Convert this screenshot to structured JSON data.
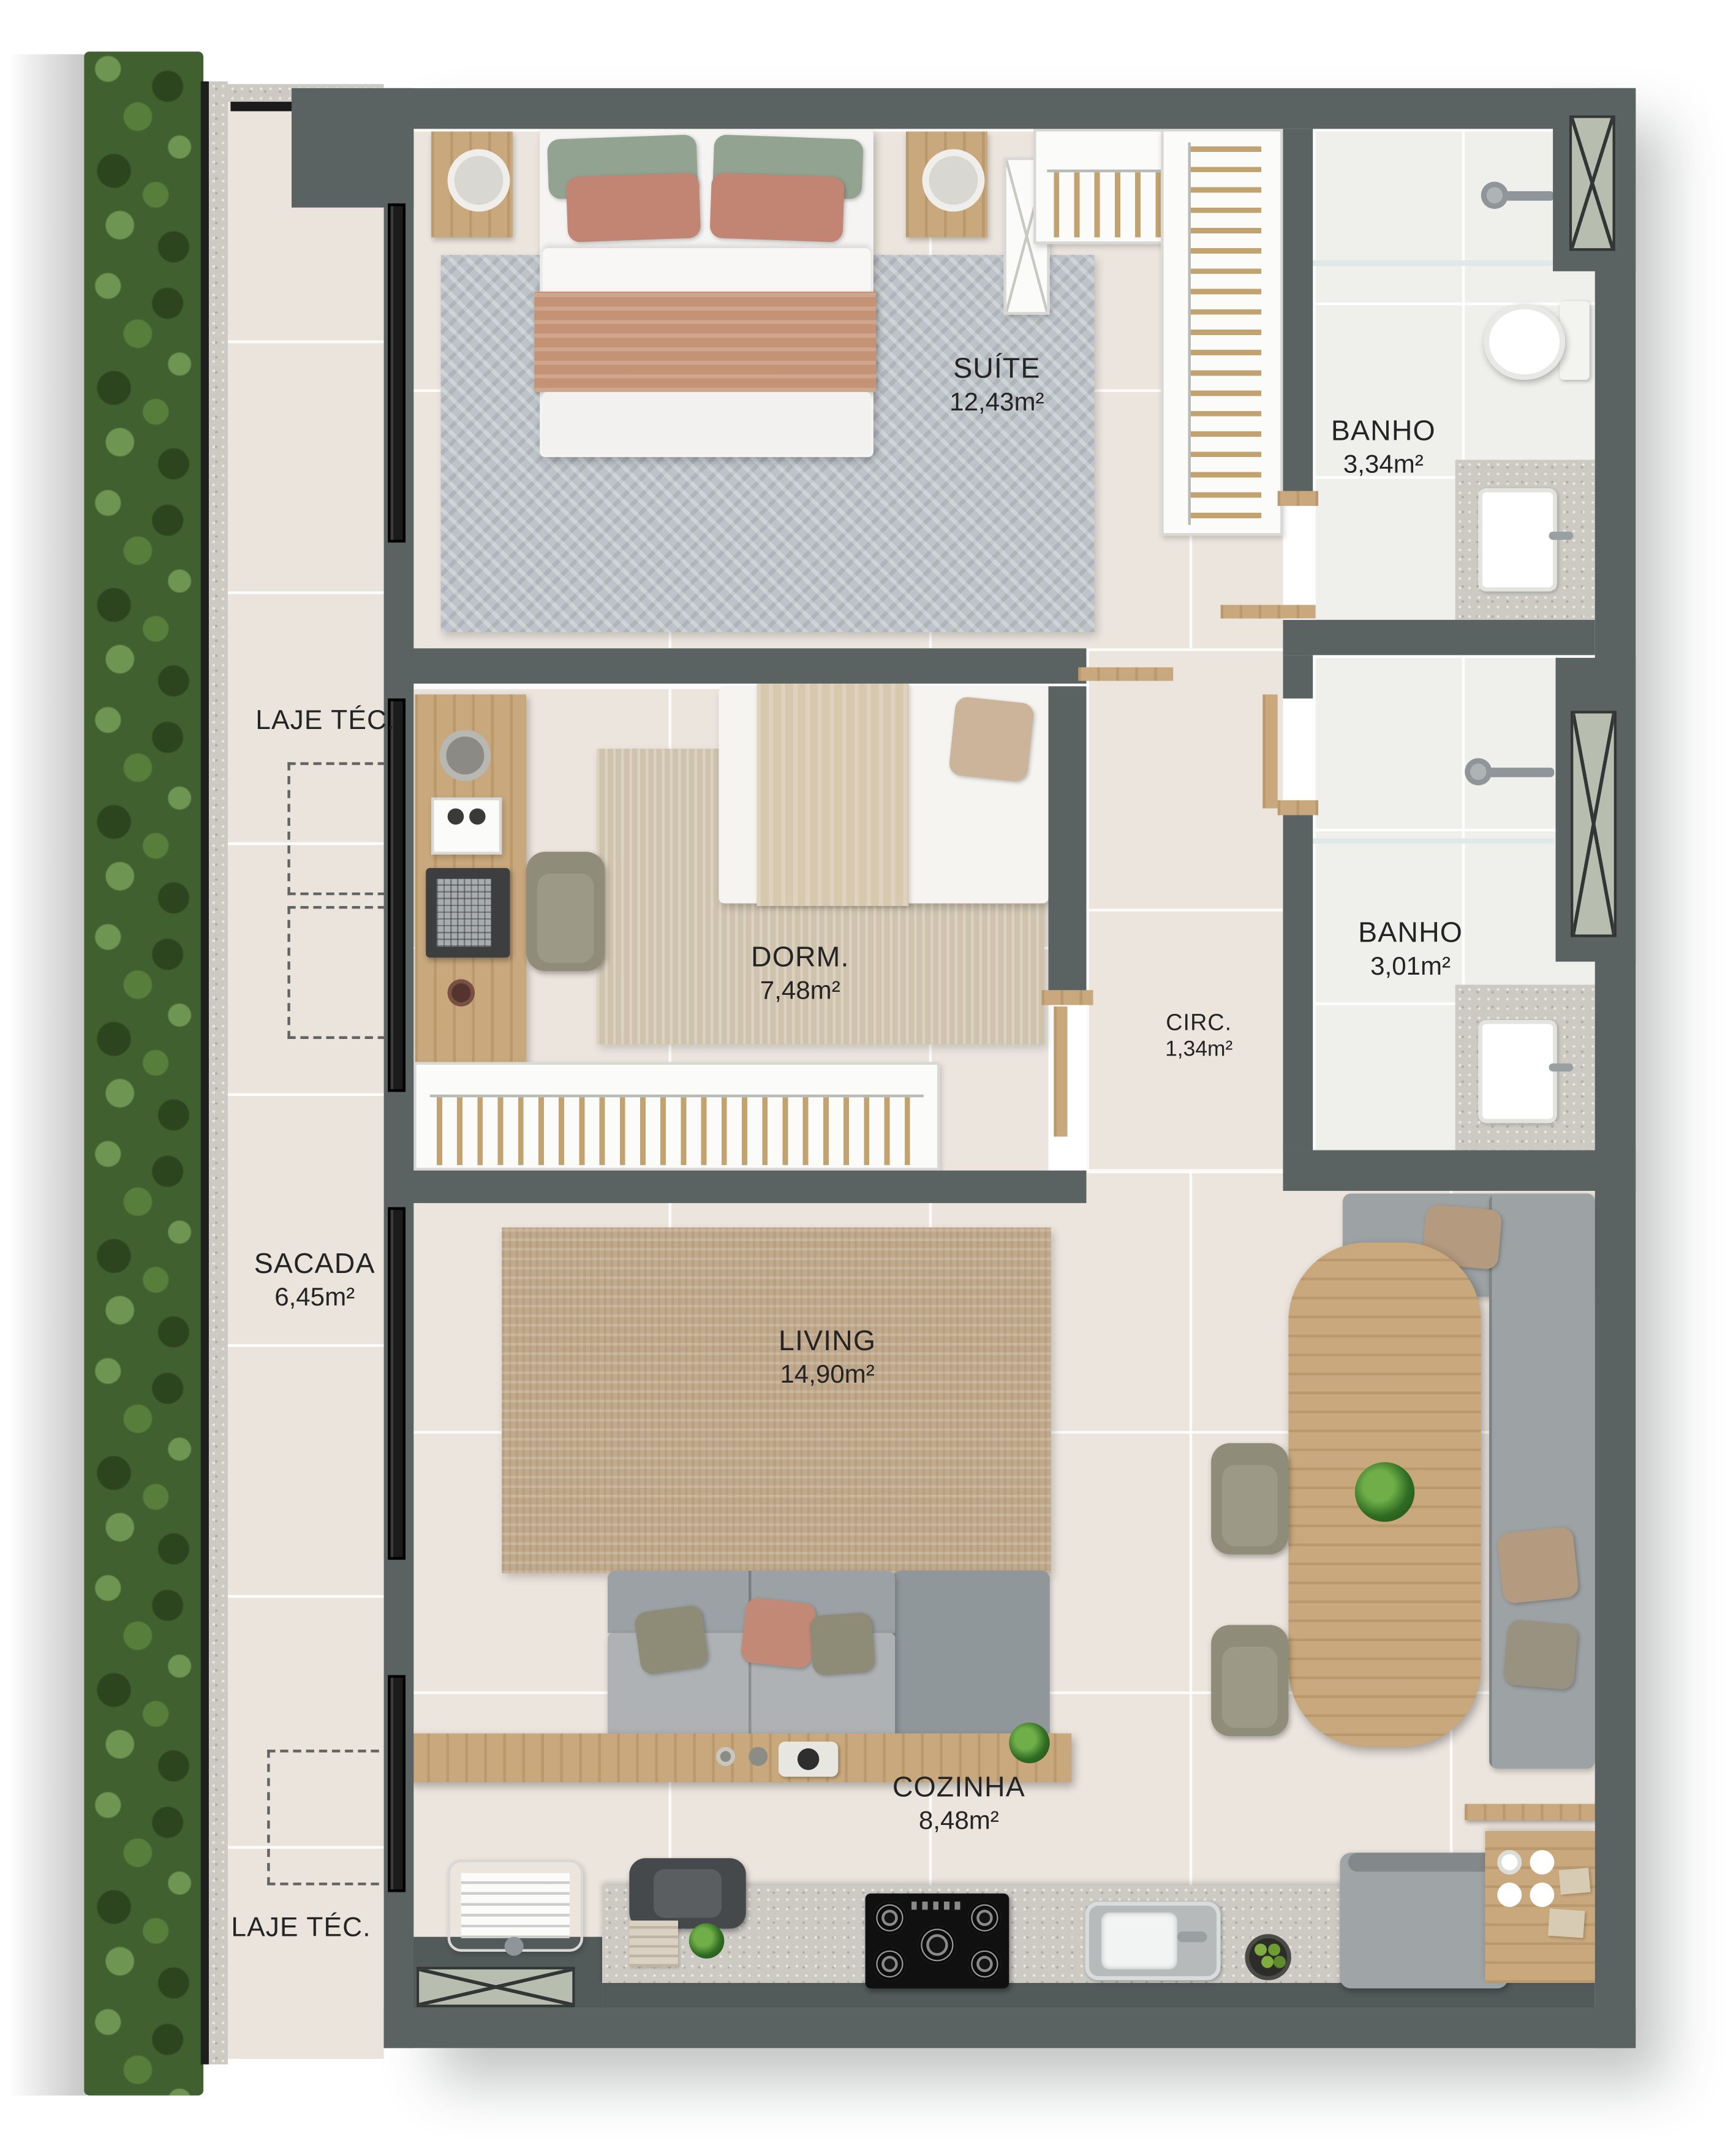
{
  "plan": {
    "type": "apartment-floor-plan",
    "rooms": [
      {
        "id": "suite",
        "name": "SUÍTE",
        "area": "12,43m²"
      },
      {
        "id": "banho-suite",
        "name": "BANHO",
        "area": "3,34m²"
      },
      {
        "id": "dorm",
        "name": "DORM.",
        "area": "7,48m²"
      },
      {
        "id": "banho-social",
        "name": "BANHO",
        "area": "3,01m²"
      },
      {
        "id": "circulacao",
        "name": "CIRC.",
        "area": "1,34m²"
      },
      {
        "id": "sacada",
        "name": "SACADA",
        "area": "6,45m²"
      },
      {
        "id": "living",
        "name": "LIVING",
        "area": "14,90m²"
      },
      {
        "id": "cozinha",
        "name": "COZINHA",
        "area": "8,48m²"
      }
    ],
    "annotations": {
      "laje_tec_top": "LAJE TÉC.",
      "laje_tec_bottom": "LAJE TÉC."
    },
    "colors": {
      "wall": "#5a6361",
      "floor": "#ece5de",
      "bath_floor": "#eff0ec",
      "balcony_floor": "#eae4dd",
      "wood": "#c8a87c",
      "rug_suite": "#bdc3c8",
      "rug_dorm": "#cfc3ae",
      "rug_living": "#c1a98c",
      "sofa_gray": "#9ba1a4",
      "hedge_green": "#41602f",
      "shaft_glass": "#b7beb0",
      "frame_black": "#1b1b1b",
      "label_text": "#242424"
    }
  }
}
